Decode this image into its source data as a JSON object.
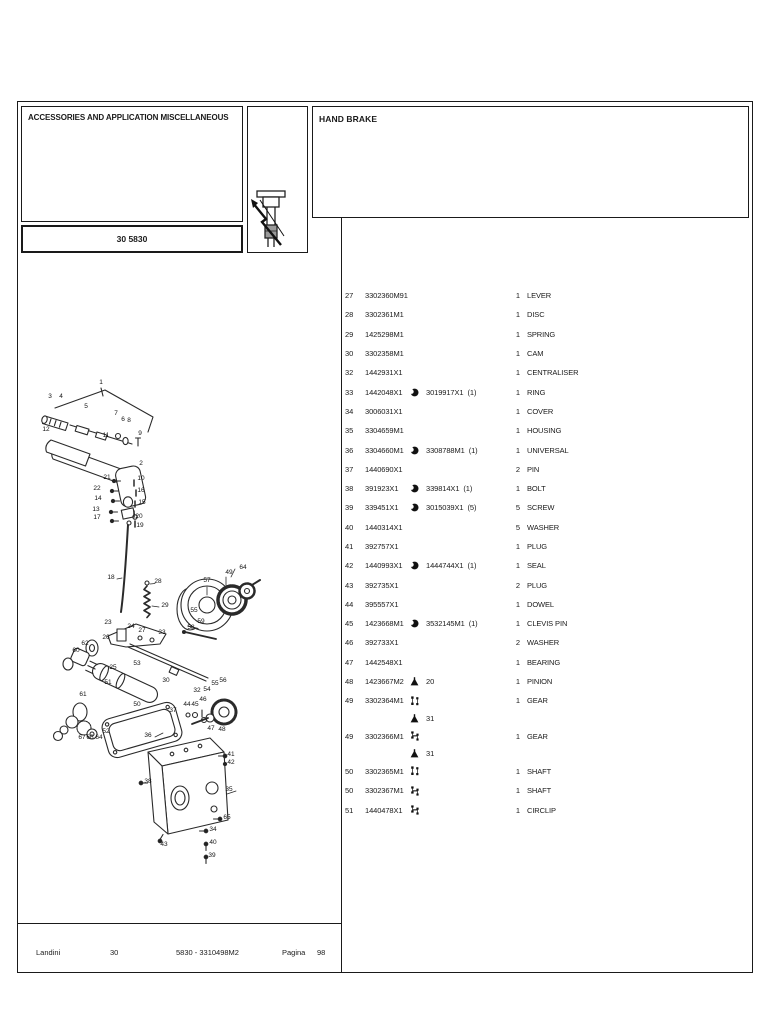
{
  "palette": {
    "ink": "#1a1a1a",
    "paper": "#ffffff",
    "icon_gray": "#999999"
  },
  "header": {
    "left_title": "ACCESSORIES AND APPLICATION MISCELLANEOUS",
    "section_code": "30 5830",
    "right_title": "HAND BRAKE",
    "icon": "hand-brake-knob-icon"
  },
  "footer": {
    "brand": "Landini",
    "section": "30",
    "model_code": "5830 - 3310498M2",
    "page_label": "Pagina",
    "page_number": "98"
  },
  "parts": {
    "marker_icons": {
      "moon": "superseded-part-icon",
      "triangle": "teeth-count-icon",
      "serial_to": "serial-break-first-icon",
      "serial_from": "serial-break-second-icon"
    },
    "rows": [
      {
        "ref": "27",
        "part": "3302360M91",
        "marker": "",
        "alt": "",
        "altq": "",
        "qty": "1",
        "desc": "LEVER"
      },
      {
        "ref": "28",
        "part": "3302361M1",
        "marker": "",
        "alt": "",
        "altq": "",
        "qty": "1",
        "desc": "DISC"
      },
      {
        "ref": "29",
        "part": "1425298M1",
        "marker": "",
        "alt": "",
        "altq": "",
        "qty": "1",
        "desc": "SPRING"
      },
      {
        "ref": "30",
        "part": "3302358M1",
        "marker": "",
        "alt": "",
        "altq": "",
        "qty": "1",
        "desc": "CAM"
      },
      {
        "ref": "32",
        "part": "1442931X1",
        "marker": "",
        "alt": "",
        "altq": "",
        "qty": "1",
        "desc": "CENTRALISER"
      },
      {
        "ref": "33",
        "part": "1442048X1",
        "marker": "moon",
        "alt": "3019917X1",
        "altq": "(1)",
        "qty": "1",
        "desc": "RING"
      },
      {
        "ref": "34",
        "part": "3006031X1",
        "marker": "",
        "alt": "",
        "altq": "",
        "qty": "1",
        "desc": "COVER"
      },
      {
        "ref": "35",
        "part": "3304659M1",
        "marker": "",
        "alt": "",
        "altq": "",
        "qty": "1",
        "desc": "HOUSING"
      },
      {
        "ref": "36",
        "part": "3304660M1",
        "marker": "moon",
        "alt": "3308788M1",
        "altq": "(1)",
        "qty": "1",
        "desc": "UNIVERSAL"
      },
      {
        "ref": "37",
        "part": "1440690X1",
        "marker": "",
        "alt": "",
        "altq": "",
        "qty": "2",
        "desc": "PIN"
      },
      {
        "ref": "38",
        "part": "391923X1",
        "marker": "moon",
        "alt": "339814X1",
        "altq": "(1)",
        "qty": "1",
        "desc": "BOLT"
      },
      {
        "ref": "39",
        "part": "339451X1",
        "marker": "moon",
        "alt": "3015039X1",
        "altq": "(5)",
        "qty": "5",
        "desc": "SCREW"
      },
      {
        "ref": "40",
        "part": "1440314X1",
        "marker": "",
        "alt": "",
        "altq": "",
        "qty": "5",
        "desc": "WASHER"
      },
      {
        "ref": "41",
        "part": "392757X1",
        "marker": "",
        "alt": "",
        "altq": "",
        "qty": "1",
        "desc": "PLUG"
      },
      {
        "ref": "42",
        "part": "1440993X1",
        "marker": "moon",
        "alt": "1444744X1",
        "altq": "(1)",
        "qty": "1",
        "desc": "SEAL"
      },
      {
        "ref": "43",
        "part": "392735X1",
        "marker": "",
        "alt": "",
        "altq": "",
        "qty": "2",
        "desc": "PLUG"
      },
      {
        "ref": "44",
        "part": "395557X1",
        "marker": "",
        "alt": "",
        "altq": "",
        "qty": "1",
        "desc": "DOWEL"
      },
      {
        "ref": "45",
        "part": "1423668M1",
        "marker": "moon",
        "alt": "3532145M1",
        "altq": "(1)",
        "qty": "1",
        "desc": "CLEVIS PIN"
      },
      {
        "ref": "46",
        "part": "392733X1",
        "marker": "",
        "alt": "",
        "altq": "",
        "qty": "2",
        "desc": "WASHER"
      },
      {
        "ref": "47",
        "part": "1442548X1",
        "marker": "",
        "alt": "",
        "altq": "",
        "qty": "1",
        "desc": "BEARING"
      },
      {
        "ref": "48",
        "part": "1423667M2",
        "marker": "triangle",
        "alt": "20",
        "altq": "",
        "qty": "1",
        "desc": "PINION"
      },
      {
        "ref": "49",
        "part": "3302364M1",
        "marker": "serial_to",
        "alt": "",
        "altq": "",
        "qty": "1",
        "desc": "GEAR",
        "sub": {
          "marker": "triangle",
          "value": "31"
        }
      },
      {
        "ref": "49",
        "part": "3302366M1",
        "marker": "serial_from",
        "alt": "",
        "altq": "",
        "qty": "1",
        "desc": "GEAR",
        "sub": {
          "marker": "triangle",
          "value": "31"
        }
      },
      {
        "ref": "50",
        "part": "3302365M1",
        "marker": "serial_to",
        "alt": "",
        "altq": "",
        "qty": "1",
        "desc": "SHAFT"
      },
      {
        "ref": "50",
        "part": "3302367M1",
        "marker": "serial_from",
        "alt": "",
        "altq": "",
        "qty": "1",
        "desc": "SHAFT"
      },
      {
        "ref": "51",
        "part": "1440478X1",
        "marker": "serial_from",
        "alt": "",
        "altq": "",
        "qty": "1",
        "desc": "CIRCLIP"
      }
    ]
  },
  "diagram": {
    "description": "exploded-view-hand-brake-assembly",
    "callouts": [
      {
        "n": "1",
        "x": 81,
        "y": 124
      },
      {
        "n": "3",
        "x": 30,
        "y": 138
      },
      {
        "n": "4",
        "x": 41,
        "y": 138
      },
      {
        "n": "5",
        "x": 66,
        "y": 148
      },
      {
        "n": "7",
        "x": 96,
        "y": 155
      },
      {
        "n": "6",
        "x": 103,
        "y": 161
      },
      {
        "n": "8",
        "x": 109,
        "y": 162
      },
      {
        "n": "9",
        "x": 120,
        "y": 175
      },
      {
        "n": "12",
        "x": 26,
        "y": 171
      },
      {
        "n": "11",
        "x": 86,
        "y": 177
      },
      {
        "n": "2",
        "x": 121,
        "y": 205
      },
      {
        "n": "21",
        "x": 87,
        "y": 219
      },
      {
        "n": "10",
        "x": 121,
        "y": 220
      },
      {
        "n": "22",
        "x": 77,
        "y": 230
      },
      {
        "n": "16",
        "x": 121,
        "y": 232
      },
      {
        "n": "14",
        "x": 78,
        "y": 240
      },
      {
        "n": "15",
        "x": 122,
        "y": 244
      },
      {
        "n": "13",
        "x": 76,
        "y": 251
      },
      {
        "n": "20",
        "x": 119,
        "y": 258
      },
      {
        "n": "17",
        "x": 77,
        "y": 259
      },
      {
        "n": "19",
        "x": 120,
        "y": 267
      },
      {
        "n": "18",
        "x": 91,
        "y": 319
      },
      {
        "n": "28",
        "x": 138,
        "y": 323
      },
      {
        "n": "29",
        "x": 145,
        "y": 347
      },
      {
        "n": "57",
        "x": 187,
        "y": 322
      },
      {
        "n": "49",
        "x": 209,
        "y": 314
      },
      {
        "n": "64",
        "x": 223,
        "y": 309
      },
      {
        "n": "55",
        "x": 174,
        "y": 352
      },
      {
        "n": "59",
        "x": 181,
        "y": 363
      },
      {
        "n": "58",
        "x": 171,
        "y": 369
      },
      {
        "n": "23",
        "x": 88,
        "y": 364
      },
      {
        "n": "24",
        "x": 111,
        "y": 368
      },
      {
        "n": "27",
        "x": 122,
        "y": 372
      },
      {
        "n": "33",
        "x": 142,
        "y": 374
      },
      {
        "n": "26",
        "x": 86,
        "y": 379
      },
      {
        "n": "62",
        "x": 65,
        "y": 385
      },
      {
        "n": "60",
        "x": 56,
        "y": 392
      },
      {
        "n": "25",
        "x": 93,
        "y": 409
      },
      {
        "n": "53",
        "x": 117,
        "y": 405
      },
      {
        "n": "30",
        "x": 146,
        "y": 422
      },
      {
        "n": "51",
        "x": 88,
        "y": 424
      },
      {
        "n": "32",
        "x": 177,
        "y": 432
      },
      {
        "n": "61",
        "x": 63,
        "y": 436
      },
      {
        "n": "50",
        "x": 117,
        "y": 446
      },
      {
        "n": "54",
        "x": 187,
        "y": 431
      },
      {
        "n": "55",
        "x": 195,
        "y": 425
      },
      {
        "n": "56",
        "x": 203,
        "y": 422
      },
      {
        "n": "44",
        "x": 167,
        "y": 446
      },
      {
        "n": "45",
        "x": 175,
        "y": 446
      },
      {
        "n": "46",
        "x": 183,
        "y": 441
      },
      {
        "n": "37",
        "x": 153,
        "y": 452
      },
      {
        "n": "47",
        "x": 191,
        "y": 470
      },
      {
        "n": "48",
        "x": 202,
        "y": 471
      },
      {
        "n": "36",
        "x": 128,
        "y": 477
      },
      {
        "n": "41",
        "x": 211,
        "y": 496
      },
      {
        "n": "42",
        "x": 211,
        "y": 504
      },
      {
        "n": "67",
        "x": 62,
        "y": 479
      },
      {
        "n": "66",
        "x": 70,
        "y": 479
      },
      {
        "n": "64",
        "x": 79,
        "y": 479
      },
      {
        "n": "52",
        "x": 86,
        "y": 473
      },
      {
        "n": "38",
        "x": 128,
        "y": 523
      },
      {
        "n": "35",
        "x": 209,
        "y": 531
      },
      {
        "n": "65",
        "x": 207,
        "y": 559
      },
      {
        "n": "34",
        "x": 193,
        "y": 571
      },
      {
        "n": "40",
        "x": 193,
        "y": 584
      },
      {
        "n": "39",
        "x": 192,
        "y": 597
      },
      {
        "n": "43",
        "x": 144,
        "y": 586
      }
    ]
  }
}
